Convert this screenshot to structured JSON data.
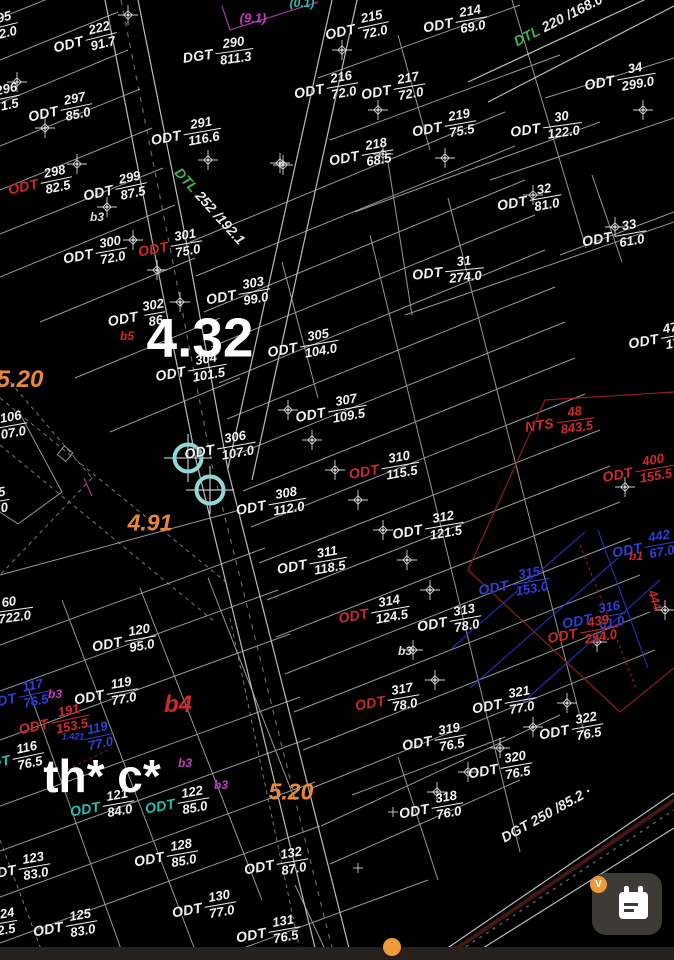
{
  "map": {
    "colors": {
      "background": "#000000",
      "line": "#b9bfc4",
      "label_white": "#f2f2f2",
      "red": "#cf2a2a",
      "blue": "#2e3fd8",
      "teal": "#27c2b2",
      "green": "#3cb54a",
      "magenta": "#c43bc4",
      "orange": "#e9883a"
    },
    "parcel_labels": [
      {
        "p": "",
        "n": "95",
        "d": "2.0",
        "x": 6,
        "y": 25,
        "r": -14
      },
      {
        "p": "ODT",
        "n": "222",
        "d": "91.7",
        "x": 85,
        "y": 40,
        "r": -14
      },
      {
        "p": "DGT",
        "n": "290",
        "d": "811.3",
        "x": 218,
        "y": 53,
        "r": -8
      },
      {
        "p": "ODT",
        "n": "215",
        "d": "72.0",
        "x": 357,
        "y": 28,
        "r": -12
      },
      {
        "p": "ODT",
        "n": "214",
        "d": "69.0",
        "x": 455,
        "y": 22,
        "r": -10
      },
      {
        "p": "ODT",
        "n": "34",
        "d": "299.0",
        "x": 620,
        "y": 79,
        "r": -10
      },
      {
        "p": "ODT",
        "n": "216",
        "d": "72.0",
        "x": 326,
        "y": 88,
        "r": -10
      },
      {
        "p": "ODT",
        "n": "217",
        "d": "72.0",
        "x": 393,
        "y": 89,
        "r": -10
      },
      {
        "p": "ODT",
        "n": "219",
        "d": "75.5",
        "x": 444,
        "y": 126,
        "r": -10
      },
      {
        "p": "ODT",
        "n": "30",
        "d": "122.0",
        "x": 546,
        "y": 127,
        "r": -8
      },
      {
        "p": "ODT",
        "n": "218",
        "d": "68.5",
        "x": 361,
        "y": 155,
        "r": -10
      },
      {
        "p": "ODT",
        "n": "32",
        "d": "81.0",
        "x": 529,
        "y": 200,
        "r": -10
      },
      {
        "p": "ODT",
        "n": "33",
        "d": "61.0",
        "x": 614,
        "y": 236,
        "r": -10
      },
      {
        "p": "ODT",
        "n": "31",
        "d": "274.0",
        "x": 448,
        "y": 271,
        "r": -6
      },
      {
        "p": "ODT",
        "n": "47",
        "d": "17",
        "x": 655,
        "y": 339,
        "r": -10
      },
      {
        "p": "",
        "n": "296",
        "d": "1.5",
        "x": 8,
        "y": 97,
        "r": -12
      },
      {
        "p": "ODT",
        "n": "297",
        "d": "85.0",
        "x": 60,
        "y": 110,
        "r": -12
      },
      {
        "p": "ODT",
        "n": "291",
        "d": "116.6",
        "x": 186,
        "y": 134,
        "r": -10
      },
      {
        "p": "ODT",
        "n": "298",
        "d": "82.5",
        "x": 40,
        "y": 183,
        "r": -12,
        "pc": "#cf2a2a"
      },
      {
        "p": "ODT",
        "n": "299",
        "d": "87.5",
        "x": 115,
        "y": 189,
        "r": -12
      },
      {
        "p": "ODT",
        "n": "300",
        "d": "72.0",
        "x": 95,
        "y": 253,
        "r": -10
      },
      {
        "p": "ODT",
        "n": "301",
        "d": "75.0",
        "x": 170,
        "y": 246,
        "r": -10,
        "pc": "#cf2a2a"
      },
      {
        "p": "ODT",
        "n": "303",
        "d": "99.0",
        "x": 238,
        "y": 294,
        "r": -10
      },
      {
        "p": "ODT",
        "n": "302",
        "d": "86",
        "x": 138,
        "y": 316,
        "r": -10
      },
      {
        "p": "ODT",
        "n": "305",
        "d": "104.0",
        "x": 303,
        "y": 346,
        "r": -10
      },
      {
        "p": "ODT",
        "n": "304",
        "d": "101.5",
        "x": 191,
        "y": 370,
        "r": -10
      },
      {
        "p": "ODT",
        "n": "307",
        "d": "109.5",
        "x": 331,
        "y": 411,
        "r": -10
      },
      {
        "p": "ODT",
        "n": "306",
        "d": "107.0",
        "x": 220,
        "y": 448,
        "r": -10
      },
      {
        "p": "ODT",
        "n": "310",
        "d": "115.5",
        "x": 384,
        "y": 468,
        "r": -10,
        "pc": "#cf2a2a"
      },
      {
        "p": "ODT",
        "n": "308",
        "d": "112.0",
        "x": 271,
        "y": 504,
        "r": -10
      },
      {
        "p": "ODT",
        "n": "312",
        "d": "121.5",
        "x": 428,
        "y": 528,
        "r": -10
      },
      {
        "p": "ODT",
        "n": "311",
        "d": "118.5",
        "x": 312,
        "y": 563,
        "r": -10
      },
      {
        "p": "NTS",
        "n": "48",
        "d": "843.5",
        "x": 560,
        "y": 422,
        "r": -8,
        "c": "#cf2a2a"
      },
      {
        "p": "ODT",
        "n": "400",
        "d": "155.5",
        "x": 638,
        "y": 471,
        "r": -10,
        "c": "#cf2a2a"
      },
      {
        "p": "ODT",
        "n": "442",
        "d": "67.0",
        "x": 644,
        "y": 547,
        "r": -10,
        "c": "#2e3fd8"
      },
      {
        "p": "ODT",
        "n": "315",
        "d": "153.0",
        "x": 514,
        "y": 584,
        "r": -10,
        "c": "#2e3fd8"
      },
      {
        "p": "ODT",
        "n": "316",
        "d": "61.0",
        "x": 594,
        "y": 618,
        "r": -10,
        "c": "#2e3fd8"
      },
      {
        "p": "ODT",
        "n": "439",
        "d": "254.0",
        "x": 583,
        "y": 632,
        "r": -10,
        "c": "#cf2a2a"
      },
      {
        "p": "ODT",
        "n": "314",
        "d": "124.5",
        "x": 374,
        "y": 612,
        "r": -10,
        "pc": "#cf2a2a"
      },
      {
        "p": "ODT",
        "n": "313",
        "d": "78.0",
        "x": 449,
        "y": 621,
        "r": -10
      },
      {
        "p": "ODT",
        "n": "317",
        "d": "78.0",
        "x": 387,
        "y": 700,
        "r": -10,
        "pc": "#cf2a2a"
      },
      {
        "p": "ODT",
        "n": "321",
        "d": "77.0",
        "x": 504,
        "y": 703,
        "r": -10
      },
      {
        "p": "ODT",
        "n": "319",
        "d": "76.5",
        "x": 434,
        "y": 740,
        "r": -10
      },
      {
        "p": "ODT",
        "n": "322",
        "d": "76.5",
        "x": 571,
        "y": 729,
        "r": -10
      },
      {
        "p": "ODT",
        "n": "320",
        "d": "76.5",
        "x": 500,
        "y": 768,
        "r": -10
      },
      {
        "p": "ODT",
        "n": "318",
        "d": "76.0",
        "x": 431,
        "y": 808,
        "r": -10
      },
      {
        "p": "",
        "n": "60",
        "d": "6722.0",
        "x": 10,
        "y": 610,
        "r": -8
      },
      {
        "p": "",
        "n": "5",
        "d": "0",
        "x": 3,
        "y": 500,
        "r": -10
      },
      {
        "p": "",
        "n": "106",
        "d": "07.0",
        "x": 12,
        "y": 425,
        "r": -10
      },
      {
        "p": "ODT",
        "n": "120",
        "d": "95.0",
        "x": 124,
        "y": 641,
        "r": -10
      },
      {
        "p": "ODT",
        "n": "119",
        "d": "77.0",
        "x": 106,
        "y": 694,
        "r": -10
      },
      {
        "p": "ODT",
        "n": "117",
        "d": "76.5",
        "x": 18,
        "y": 697,
        "r": -12,
        "c": "#2e3fd8"
      },
      {
        "p": "ODT",
        "n": "191",
        "d": "153.5",
        "x": 54,
        "y": 722,
        "r": -12,
        "c": "#cf2a2a"
      },
      {
        "p": "",
        "n": "119",
        "d": "77.0",
        "x": 99,
        "y": 736,
        "r": -12,
        "c": "#2e3fd8"
      },
      {
        "p": "ODT",
        "n": "116",
        "d": "76.5",
        "x": 12,
        "y": 759,
        "r": -12,
        "pc": "#27c2b2"
      },
      {
        "p": "ODT",
        "n": "121",
        "d": "84.0",
        "x": 102,
        "y": 806,
        "r": -10,
        "pc": "#27c2b2"
      },
      {
        "p": "ODT",
        "n": "122",
        "d": "85.0",
        "x": 177,
        "y": 803,
        "r": -10,
        "pc": "#27c2b2"
      },
      {
        "p": "ODT",
        "n": "128",
        "d": "85.0",
        "x": 166,
        "y": 856,
        "r": -10
      },
      {
        "p": "ODT",
        "n": "123",
        "d": "83.0",
        "x": 18,
        "y": 869,
        "r": -10
      },
      {
        "p": "ODT",
        "n": "130",
        "d": "77.0",
        "x": 204,
        "y": 907,
        "r": -10
      },
      {
        "p": "",
        "n": "124",
        "d": "2.5",
        "x": 5,
        "y": 922,
        "r": -10
      },
      {
        "p": "ODT",
        "n": "125",
        "d": "83.0",
        "x": 65,
        "y": 926,
        "r": -10
      },
      {
        "p": "ODT",
        "n": "132",
        "d": "87.0",
        "x": 276,
        "y": 864,
        "r": -10
      },
      {
        "p": "ODT",
        "n": "131",
        "d": "76.5",
        "x": 268,
        "y": 932,
        "r": -10
      }
    ],
    "road_labels": [
      {
        "p": "DTL",
        "t": "252 /192.1",
        "x": 210,
        "y": 206,
        "r": 48,
        "pc": "#3cb54a"
      },
      {
        "p": "DTL",
        "t": "220 /168.0",
        "x": 558,
        "y": 20,
        "r": -27,
        "pc": "#3cb54a"
      },
      {
        "p": "DGT",
        "t": "250 /85.2 ·",
        "x": 546,
        "y": 814,
        "r": -29,
        "pc": "#e8e8e8"
      }
    ],
    "big_labels": [
      {
        "text": "4.32",
        "x": 200,
        "y": 338,
        "size": 55,
        "color": "#ffffff",
        "italic": false
      },
      {
        "text": "th* c*",
        "x": 102,
        "y": 776,
        "size": 46,
        "color": "#ffffff",
        "italic": false
      },
      {
        "text": "5.20",
        "x": 20,
        "y": 380,
        "size": 24,
        "color": "#e9883a",
        "italic": true
      },
      {
        "text": "4.91",
        "x": 150,
        "y": 523,
        "size": 23,
        "color": "#e9883a",
        "italic": true
      },
      {
        "text": "5.20",
        "x": 291,
        "y": 792,
        "size": 23,
        "color": "#e9883a",
        "italic": true
      },
      {
        "text": "b4",
        "x": 178,
        "y": 705,
        "size": 24,
        "color": "#cf2a2a",
        "italic": true
      }
    ],
    "small_labels": [
      {
        "text": "(9.1)",
        "x": 253,
        "y": 18,
        "color": "#c43bc4",
        "size": 13
      },
      {
        "text": "(0.1)",
        "x": 302,
        "y": 3,
        "color": "#27c2b2",
        "size": 12
      },
      {
        "text": "b3",
        "x": 97,
        "y": 217,
        "color": "#dddddd",
        "size": 12
      },
      {
        "text": "b5",
        "x": 127,
        "y": 336,
        "color": "#cf2a2a",
        "size": 12
      },
      {
        "text": "b3",
        "x": 405,
        "y": 651,
        "color": "#dddddd",
        "size": 12
      },
      {
        "text": "b1",
        "x": 636,
        "y": 556,
        "color": "#cf2a2a",
        "size": 12
      },
      {
        "text": "b3",
        "x": 55,
        "y": 694,
        "color": "#c43bc4",
        "size": 12
      },
      {
        "text": "b3",
        "x": 185,
        "y": 763,
        "color": "#c43bc4",
        "size": 12
      },
      {
        "text": "b3",
        "x": 221,
        "y": 785,
        "color": "#c43bc4",
        "size": 12
      },
      {
        "text": "1.421",
        "x": 73,
        "y": 737,
        "color": "#2e3fd8",
        "size": 9
      },
      {
        "text": "444",
        "x": 655,
        "y": 600,
        "color": "#cf2a2a",
        "size": 12,
        "rot": 72
      }
    ],
    "markers": [
      [
        128,
        15
      ],
      [
        17,
        82
      ],
      [
        45,
        128
      ],
      [
        77,
        164
      ],
      [
        208,
        160
      ],
      [
        283,
        165
      ],
      [
        280,
        163
      ],
      [
        107,
        207
      ],
      [
        342,
        50
      ],
      [
        378,
        110
      ],
      [
        445,
        158
      ],
      [
        383,
        154
      ],
      [
        643,
        110
      ],
      [
        533,
        195
      ],
      [
        615,
        227
      ],
      [
        133,
        240
      ],
      [
        157,
        270
      ],
      [
        180,
        302
      ],
      [
        288,
        410
      ],
      [
        312,
        440
      ],
      [
        335,
        470
      ],
      [
        358,
        500
      ],
      [
        383,
        530
      ],
      [
        407,
        560
      ],
      [
        430,
        590
      ],
      [
        413,
        650
      ],
      [
        435,
        680
      ],
      [
        567,
        703
      ],
      [
        533,
        727
      ],
      [
        500,
        748
      ],
      [
        468,
        772
      ],
      [
        437,
        792
      ],
      [
        625,
        487
      ],
      [
        665,
        610
      ],
      [
        597,
        642
      ],
      [
        358,
        868,
        1
      ],
      [
        393,
        812,
        1
      ]
    ],
    "selection_markers": [
      {
        "x": 188,
        "y": 458
      },
      {
        "x": 210,
        "y": 490
      }
    ],
    "calendar_button": {
      "badge": "V"
    }
  }
}
